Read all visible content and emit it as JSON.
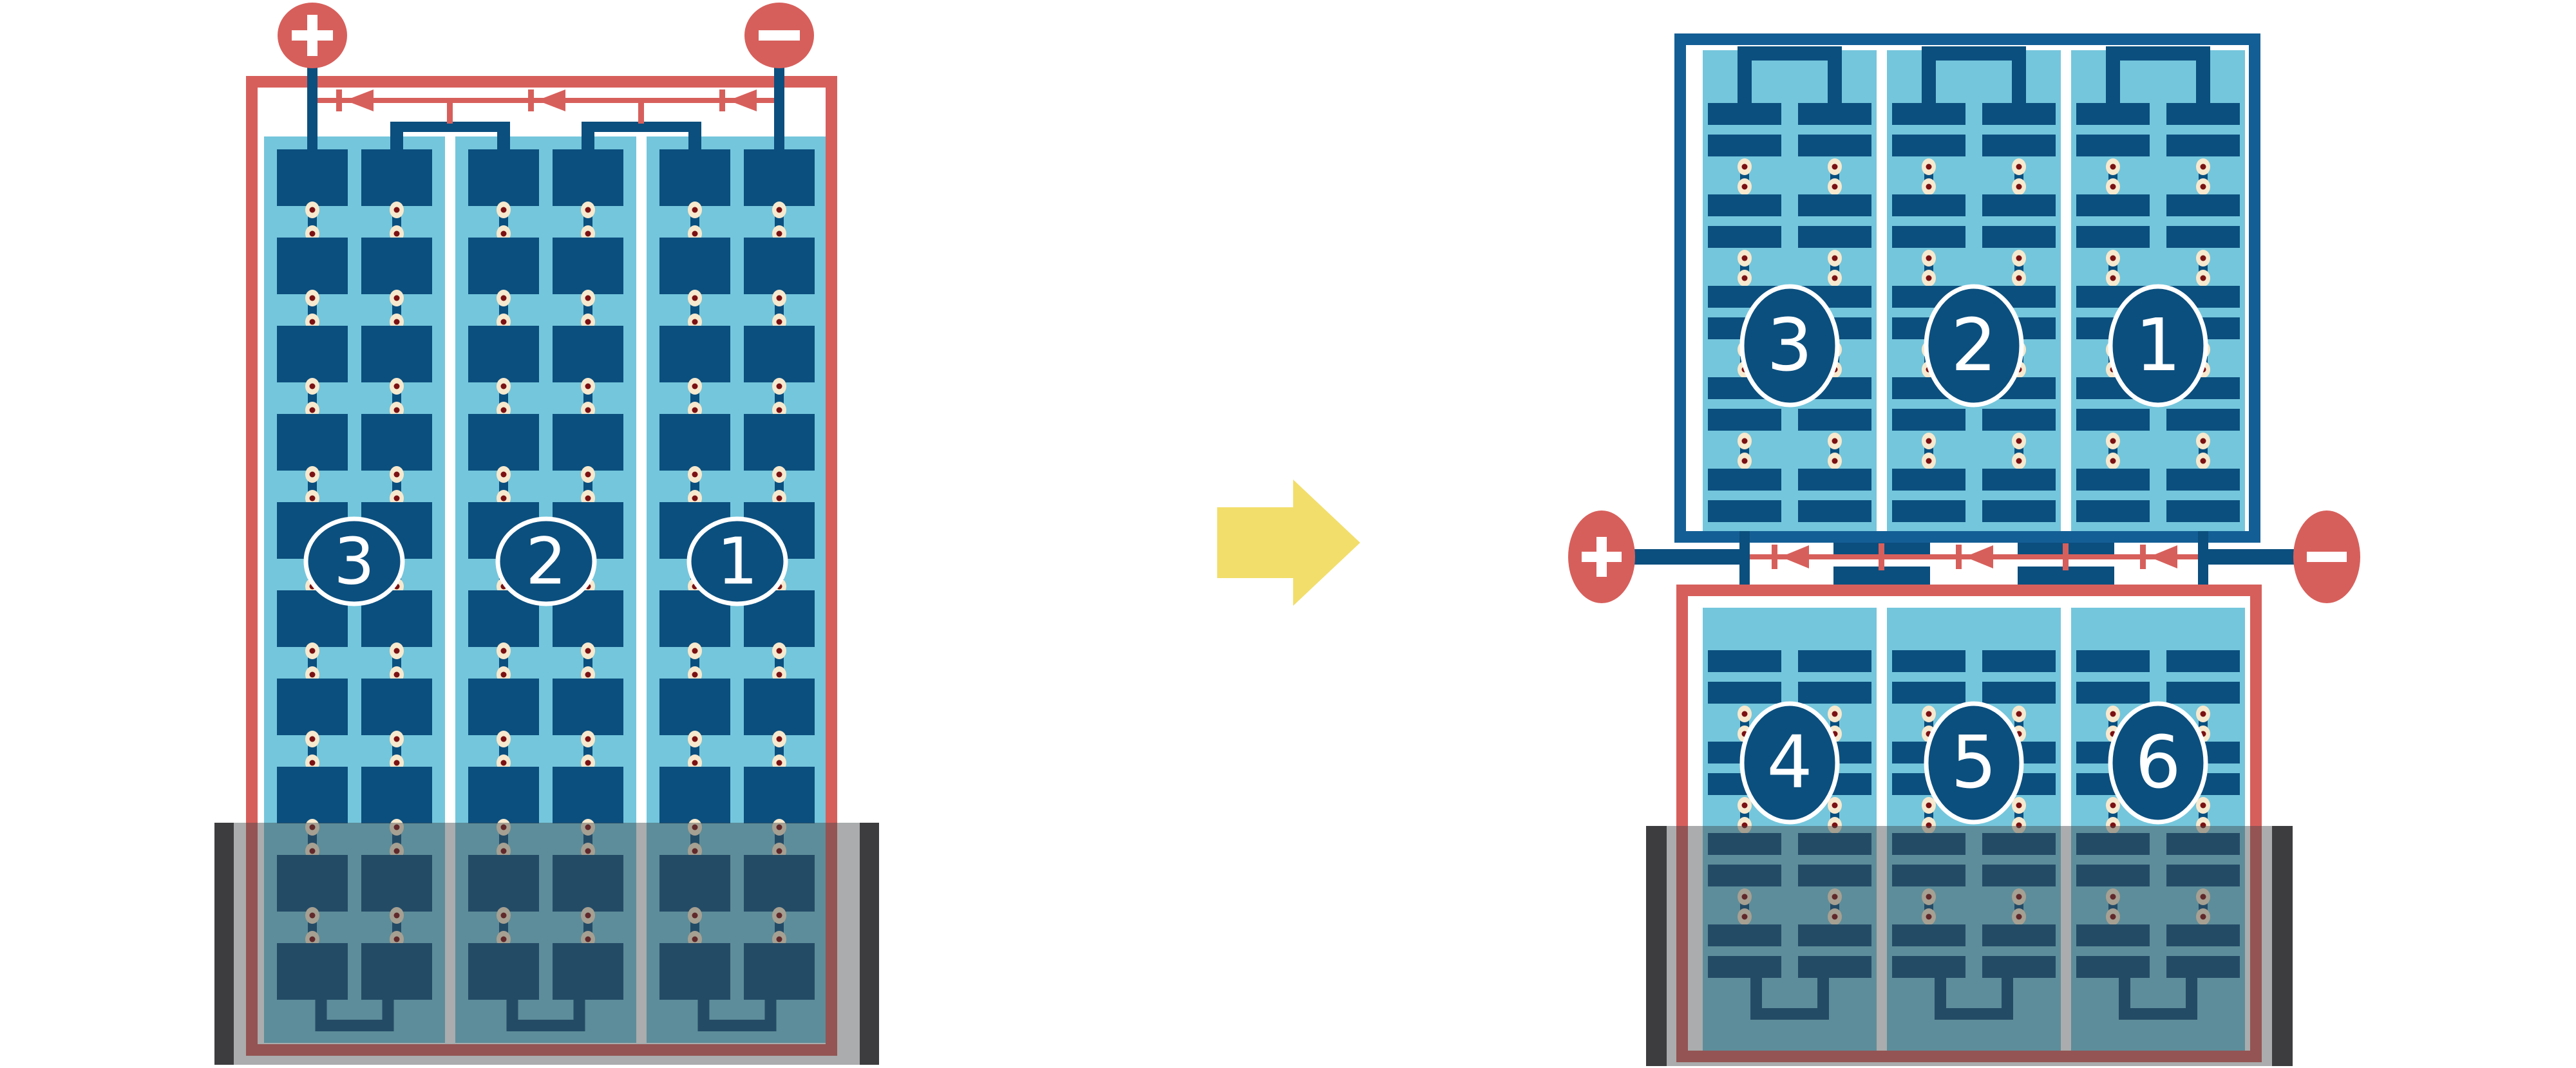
{
  "diagram_title": "",
  "colors": {
    "red": "#D75F5B",
    "dark_blue": "#0B4F7E",
    "frame_blue": "#135E95",
    "light_blue": "#74C6DC",
    "rivet_cream": "#F7E9CE",
    "rivet_dot": "#7B1113",
    "yellow": "#F2DE6B",
    "overlay": "rgba(66,70,73,0.45)",
    "overlay_bar": "rgba(45,46,48,0.88)"
  },
  "left_battery": {
    "terminals": {
      "positive_label": "+",
      "negative_label": "−"
    },
    "cells": [
      {
        "label": "3"
      },
      {
        "label": "2"
      },
      {
        "label": "1"
      }
    ]
  },
  "transform_arrow": {
    "direction": "right"
  },
  "right_battery": {
    "terminals": {
      "positive_label": "+",
      "negative_label": "−"
    },
    "top_cells": [
      {
        "label": "3"
      },
      {
        "label": "2"
      },
      {
        "label": "1"
      }
    ],
    "bottom_cells": [
      {
        "label": "4"
      },
      {
        "label": "5"
      },
      {
        "label": "6"
      }
    ]
  }
}
